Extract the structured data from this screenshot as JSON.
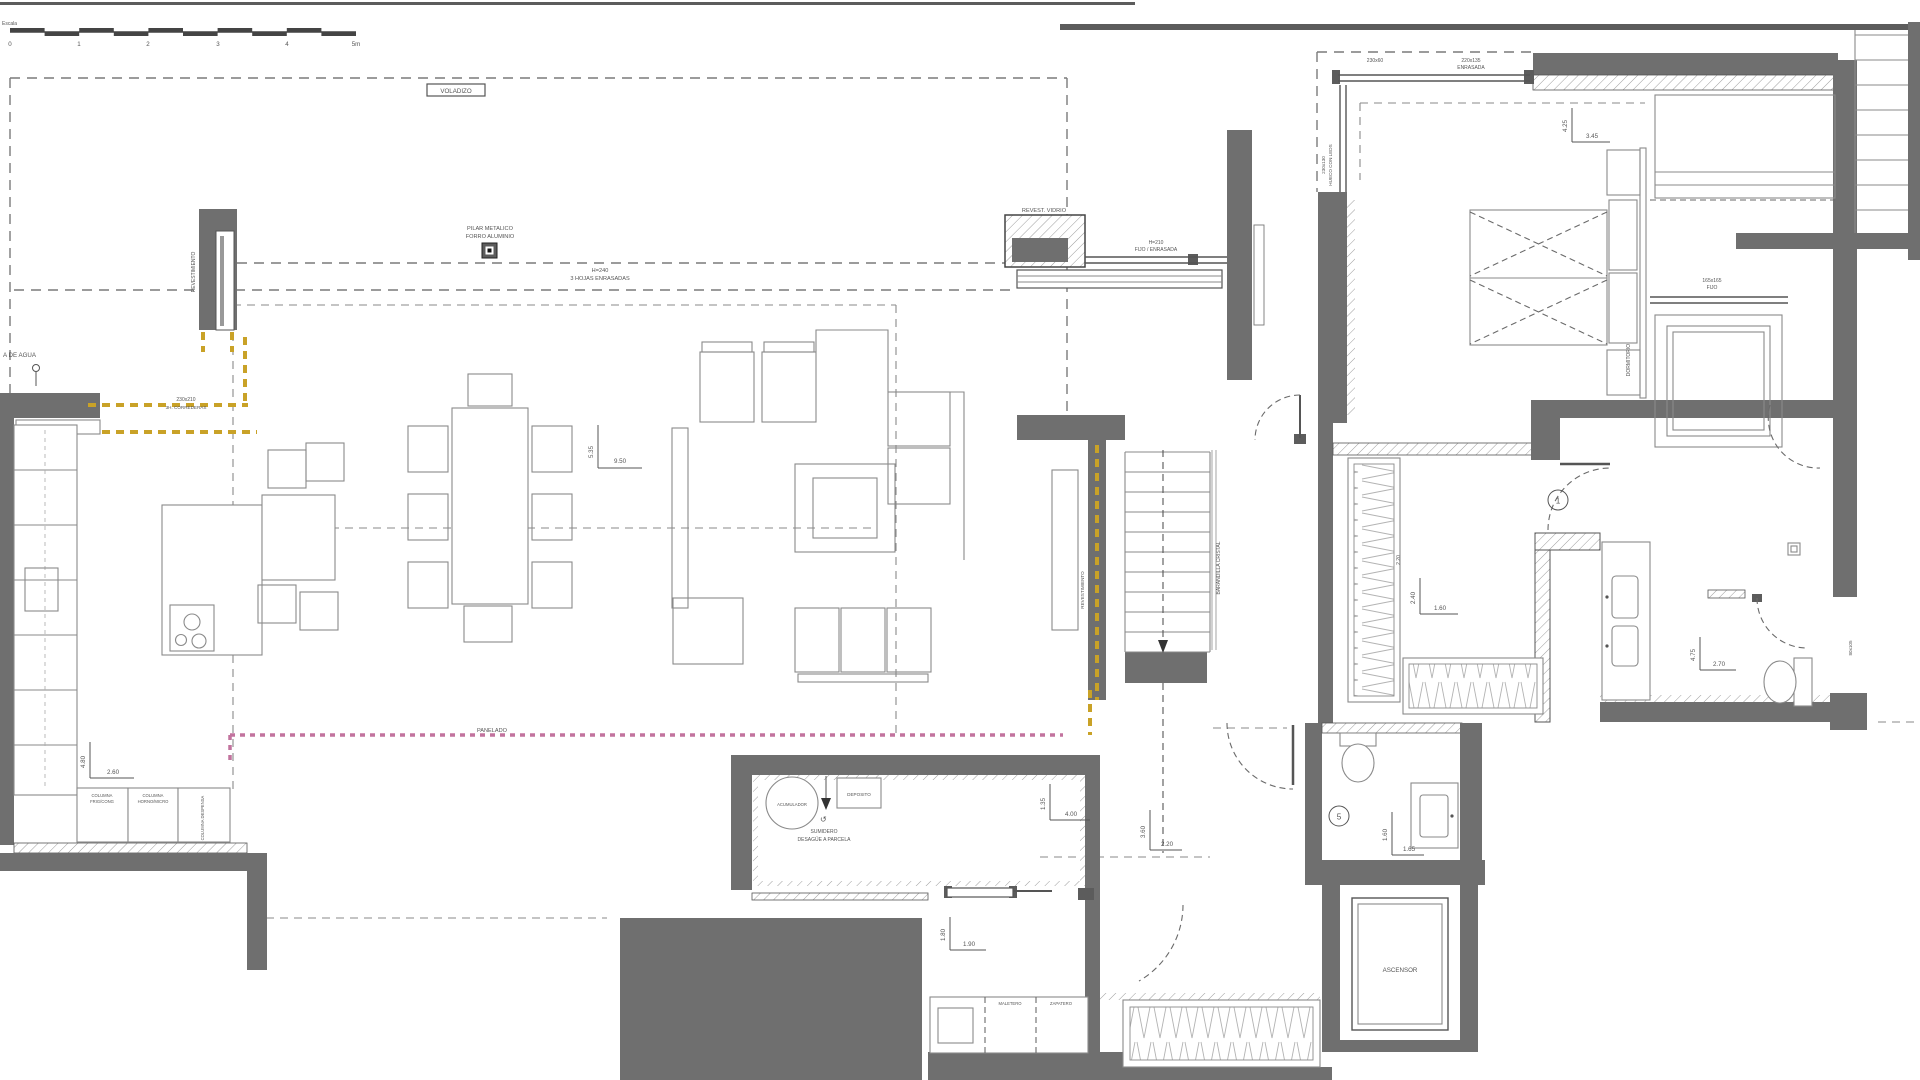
{
  "scale": {
    "label": "Escala",
    "ticks": [
      "0",
      "1",
      "2",
      "3",
      "4",
      "5m"
    ]
  },
  "labels": {
    "voladizo": "VOLADIZO",
    "pilar_l1": "PILAR METALICO",
    "pilar_l2": "FORRO ALUMINIO",
    "hojas_l1": "H=240",
    "hojas_l2": "3 HOJAS ENRASADAS",
    "revest_vidrio": "REVEST. VIDRIO",
    "fijo_l1": "H=210",
    "fijo_l2": "FIJO / ENRASADA",
    "win_230x60": "230x60",
    "win_220x135_l1": "220x135",
    "win_220x135_l2": "ENRASADA",
    "win_230x130_l1": "230x130",
    "win_230x130_l2": "HUECO CON LEDS",
    "win_165_l1": "165x165",
    "win_165_l2": "FIJO",
    "win_230x210_l1": "230x210",
    "win_230x210_l2": "3H. CORREDERAS",
    "lat_80x105": "80x105",
    "panelado": "PANELADO",
    "revestimiento_1": "REVESTIMIENTO",
    "revestimiento_2": "REVESTIMIENTO",
    "barandilla": "BARANDILLA CRISTAL",
    "dormitorio": "DORMITORIO",
    "ascensor": "ASCENSOR",
    "agua": "A DE AGUA",
    "acumulador": "ACUMULADOR",
    "deposito": "DEPOSITO",
    "sumidero_l1": "SUMIDERO",
    "sumidero_l2": "DESAGÜE A PARCELA",
    "maletero": "MALETERO",
    "zapatero": "ZAPATERO",
    "col1_l1": "COLUMNA",
    "col1_l2": "FRIG/CONG",
    "col2_l1": "COLUMNA",
    "col2_l2": "HORNO/MICRO",
    "col3": "COLUMNA DESPENSA",
    "closet_220": "2.20"
  },
  "door_tags": {
    "d1": "1",
    "d5": "5"
  },
  "dims": {
    "living_v": "5.35",
    "living_h": "9.50",
    "bedroom_v": "4.25",
    "bedroom_h": "3.45",
    "bath_v": "4.75",
    "bath_h": "2.70",
    "closet_v": "2.40",
    "closet_h": "1.60",
    "aseo_v": "1.60",
    "aseo_h": "1.65",
    "hall_v": "3.60",
    "hall_h": "2.20",
    "util_v": "1.35",
    "util_h": "4.00",
    "entry_v": "1.80",
    "entry_h": "1.90",
    "kitchen_v": "4.80",
    "kitchen_h": "2.60"
  },
  "colors": {
    "wall": "#6f6f6f",
    "wall_dark": "#5c5c5c",
    "line": "#555555",
    "furniture": "#8a8a8a",
    "accent_yellow": "#c9a227",
    "accent_pink": "#c2739e",
    "dashed": "#7a7a7a",
    "text": "#555555",
    "paper": "#ffffff"
  }
}
